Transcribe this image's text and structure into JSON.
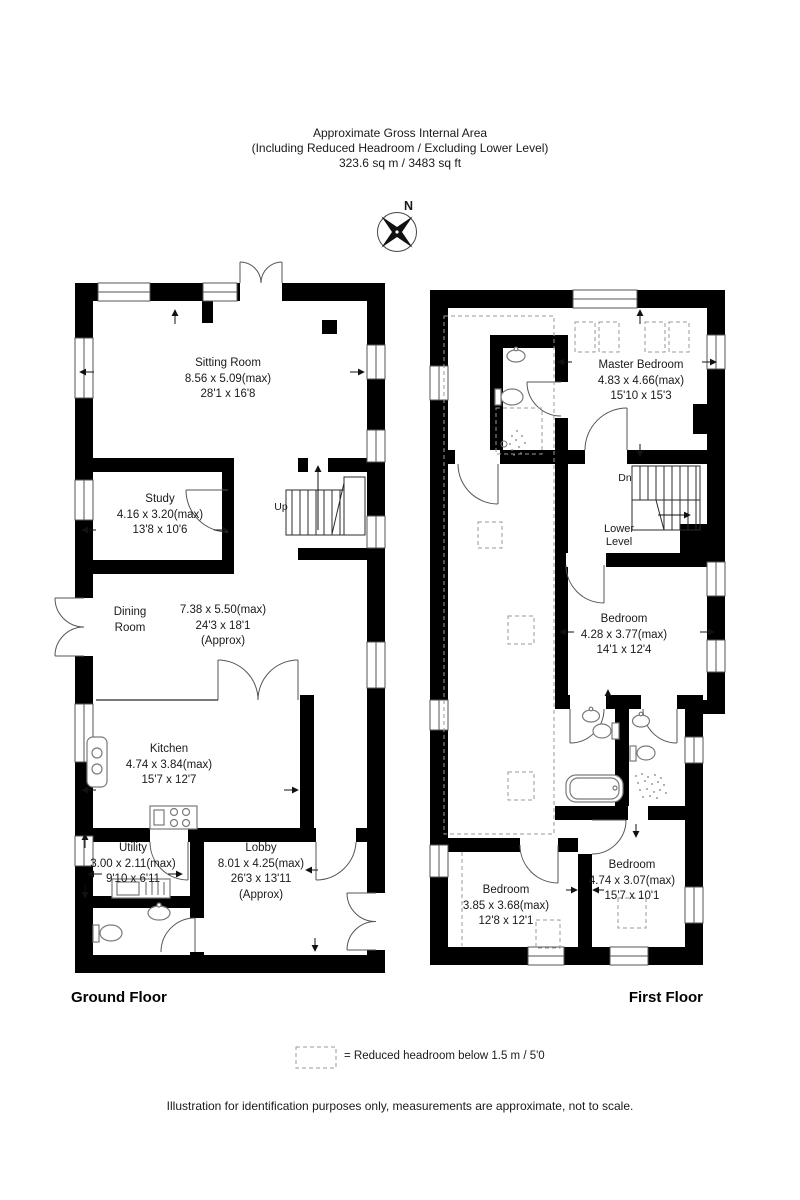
{
  "header": {
    "line1": "Approximate Gross Internal Area",
    "line2": "(Including Reduced Headroom / Excluding Lower Level)",
    "line3": "323.6 sq m / 3483 sq ft"
  },
  "compass": {
    "north_label": "N"
  },
  "ground_floor": {
    "title": "Ground Floor",
    "stair_label": "Up",
    "rooms": {
      "sitting_room": {
        "name": "Sitting Room",
        "metric": "8.56 x 5.09(max)",
        "imperial": "28'1 x 16'8"
      },
      "study": {
        "name": "Study",
        "metric": "4.16 x 3.20(max)",
        "imperial": "13'8 x 10'6"
      },
      "dining_room": {
        "name_line1": "Dining",
        "name_line2": "Room",
        "metric": "7.38 x 5.50(max)",
        "imperial": "24'3 x 18'1",
        "approx": "(Approx)"
      },
      "kitchen": {
        "name": "Kitchen",
        "metric": "4.74 x 3.84(max)",
        "imperial": "15'7 x 12'7"
      },
      "utility": {
        "name": "Utility",
        "metric": "3.00 x 2.11(max)",
        "imperial": "9'10 x 6'11"
      },
      "lobby": {
        "name": "Lobby",
        "metric": "8.01 x 4.25(max)",
        "imperial": "26'3 x 13'11",
        "approx": "(Approx)"
      }
    }
  },
  "first_floor": {
    "title": "First Floor",
    "stair_label": "Dn",
    "lower_level": {
      "line1": "Lower",
      "line2": "Level"
    },
    "rooms": {
      "master_bedroom": {
        "name": "Master Bedroom",
        "metric": "4.83 x 4.66(max)",
        "imperial": "15'10 x 15'3"
      },
      "bedroom_middle": {
        "name": "Bedroom",
        "metric": "4.28 x 3.77(max)",
        "imperial": "14'1 x 12'4"
      },
      "bedroom_bottom_left": {
        "name": "Bedroom",
        "metric": "3.85 x 3.68(max)",
        "imperial": "12'8 x 12'1"
      },
      "bedroom_bottom_right": {
        "name": "Bedroom",
        "metric": "4.74 x 3.07(max)",
        "imperial": "15'7 x 10'1"
      }
    }
  },
  "legend": {
    "label": "=  Reduced headroom below 1.5 m / 5'0"
  },
  "footer": {
    "disclaimer": "Illustration for identification purposes only, measurements are approximate, not to scale."
  },
  "colors": {
    "wall": "#000000",
    "line": "#2b2b2b",
    "fixture": "#7a7a7a",
    "dashed": "#999999",
    "text": "#1a1a1a"
  }
}
